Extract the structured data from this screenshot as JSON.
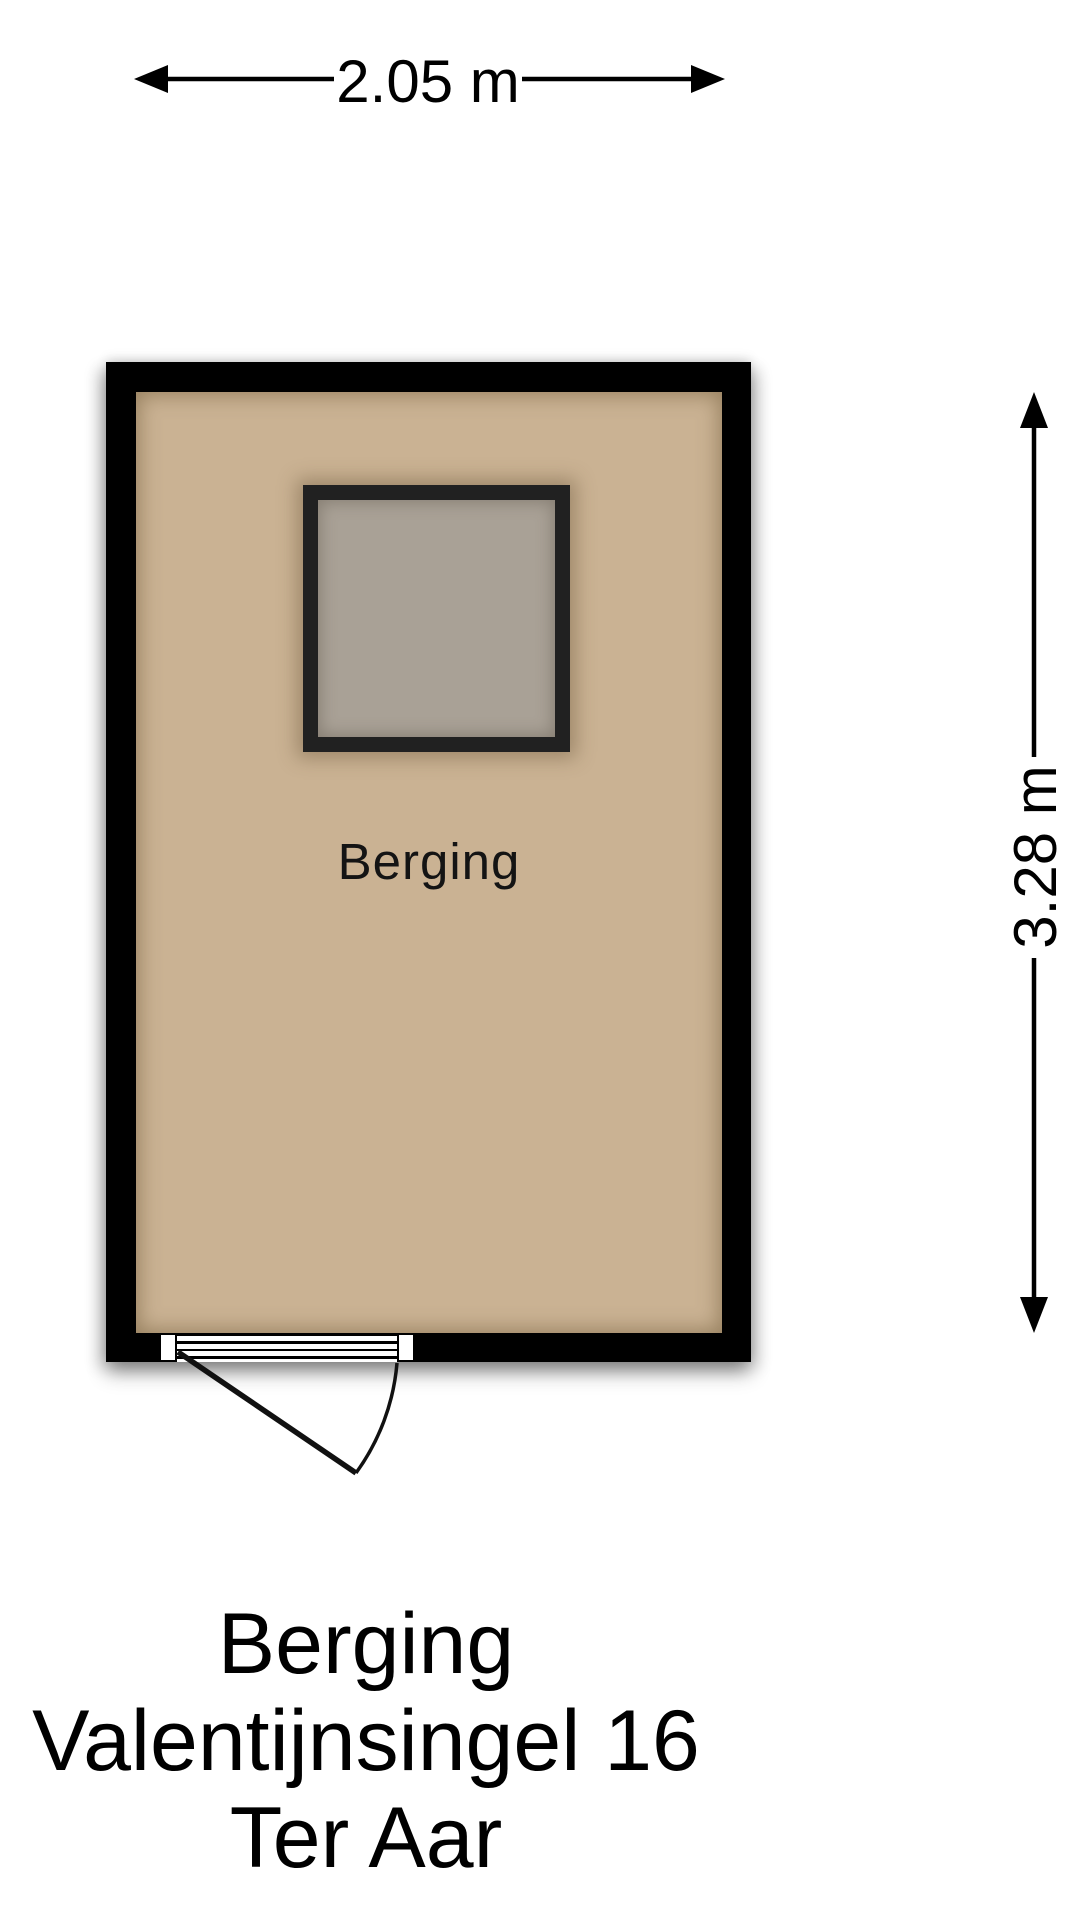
{
  "dimensions": {
    "width_label": "2.05 m",
    "height_label": "3.28 m"
  },
  "room": {
    "label": "Berging"
  },
  "title": {
    "lines": [
      "Berging",
      "Valentijnsingel 16",
      "Ter Aar"
    ]
  },
  "icons": {
    "arrows": [
      "arrow-left-icon",
      "arrow-right-icon",
      "arrow-up-icon",
      "arrow-down-icon"
    ]
  },
  "colors": {
    "background": "#ffffff",
    "wall": "#000000",
    "floor": "#cab293",
    "skylight_fill": "#a9a196",
    "skylight_frame": "#212121",
    "line": "#000000"
  }
}
